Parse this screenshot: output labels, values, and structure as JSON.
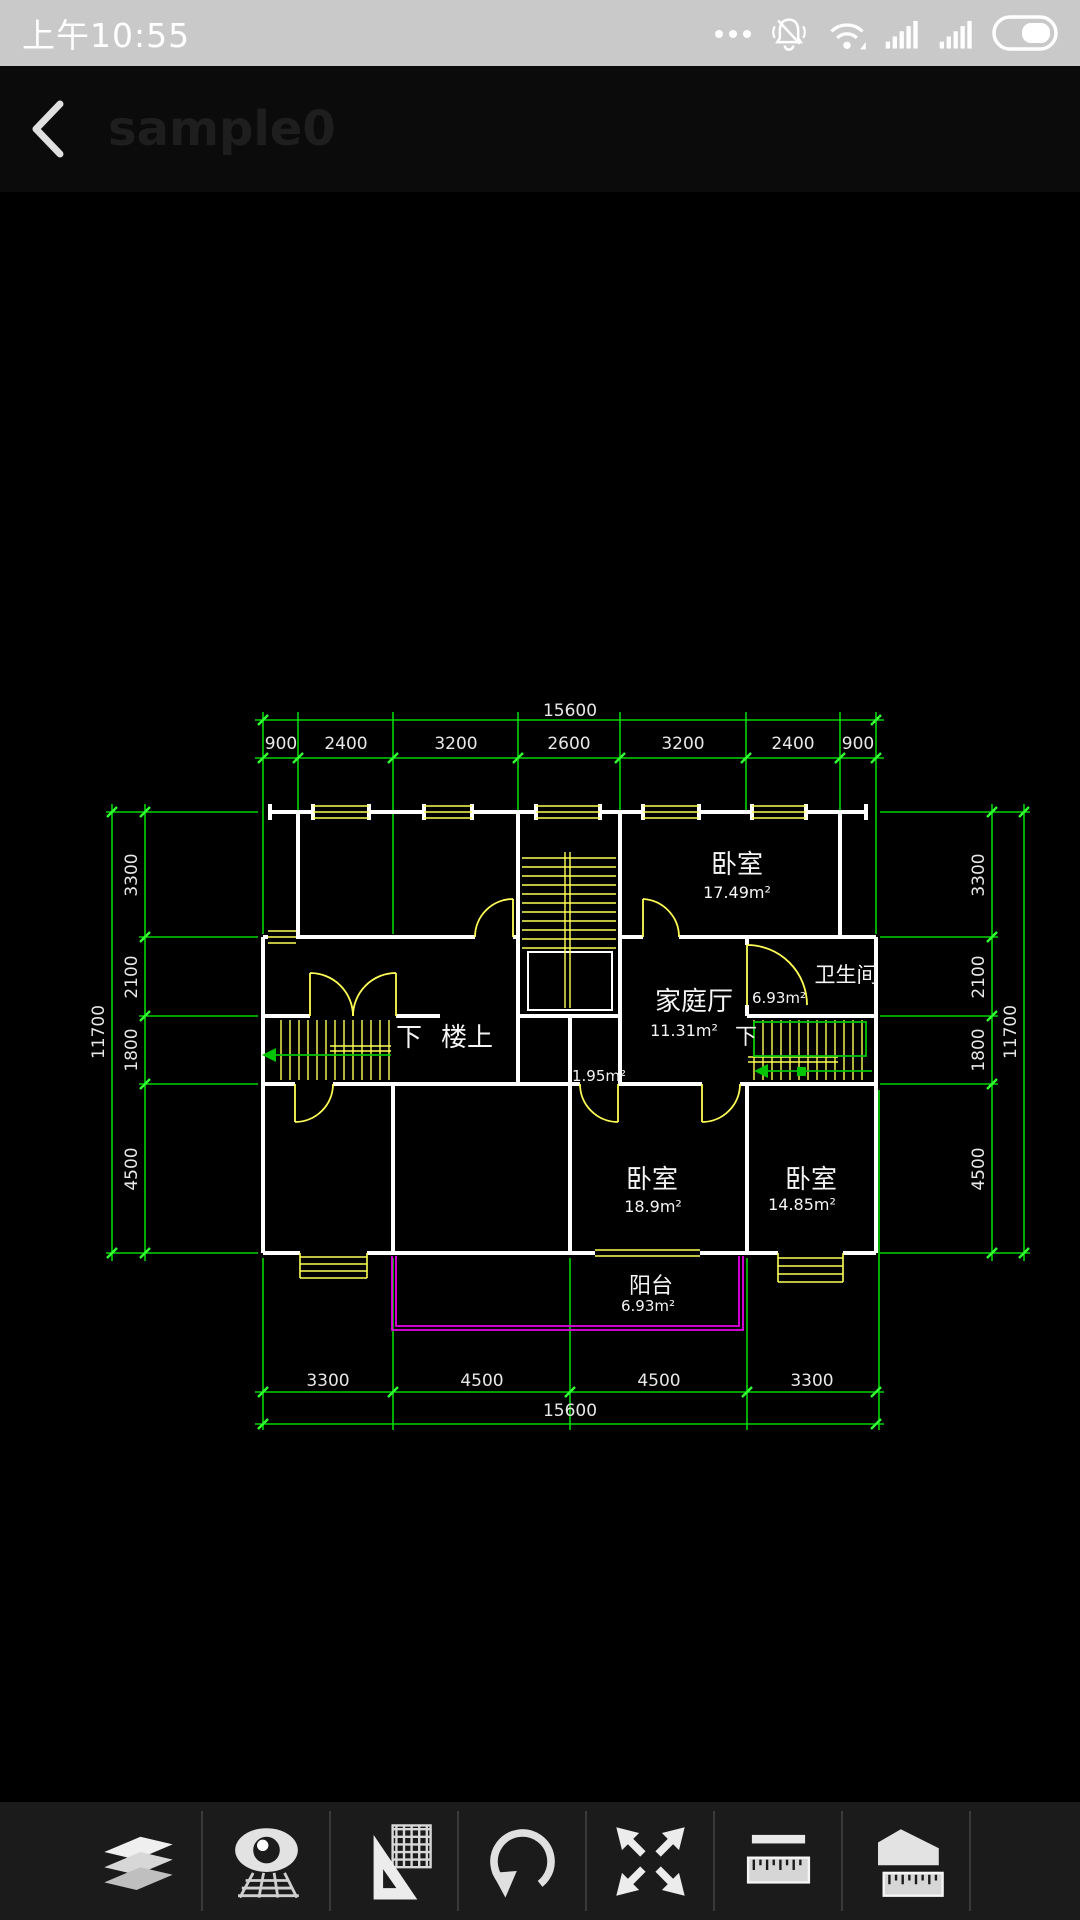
{
  "status_bar": {
    "time": "上午10:55",
    "icons": [
      "more-notifications",
      "mute",
      "wifi",
      "signal-sim1",
      "signal-sim2",
      "battery"
    ]
  },
  "title_bar": {
    "title": "sample0"
  },
  "drawing": {
    "dimensions": {
      "top_total": "15600",
      "top_segments": [
        "900",
        "2400",
        "3200",
        "2600",
        "3200",
        "2400",
        "900"
      ],
      "left_total": "11700",
      "left_segments": [
        "3300",
        "2100",
        "1800",
        "4500"
      ],
      "right_total": "11700",
      "right_segments": [
        "3300",
        "2100",
        "1800",
        "4500"
      ],
      "bottom_segments": [
        "3300",
        "4500",
        "4500",
        "3300"
      ],
      "bottom_total": "15600"
    },
    "rooms": [
      {
        "id": "bedroom-top",
        "name": "卧室",
        "area": "17.49m²"
      },
      {
        "id": "bathroom",
        "name": "卫生间",
        "area": "6.93m²"
      },
      {
        "id": "family-hall",
        "name": "家庭厅",
        "area": "11.31m²"
      },
      {
        "id": "bedroom-left",
        "name": "卧室",
        "area": "18.9m²"
      },
      {
        "id": "bedroom-right",
        "name": "卧室",
        "area": "14.85m²"
      },
      {
        "id": "balcony",
        "name": "阳台",
        "area": "6.93m²"
      }
    ],
    "annotations": {
      "down_left": "下",
      "upstairs": "楼上",
      "down_right": "下",
      "closet_area": "1.95m²"
    },
    "colors": {
      "dimension_line": "#00d400",
      "tick": "#33ff33",
      "wall": "#ffffff",
      "window_door": "#ffff55",
      "balcony_line": "#e800e8",
      "label_text": "#f2f2f2"
    }
  },
  "toolbar": {
    "items": [
      {
        "name": "layers"
      },
      {
        "name": "visual-style"
      },
      {
        "name": "drawing-tools"
      },
      {
        "name": "rotate"
      },
      {
        "name": "fit-screen"
      },
      {
        "name": "measure-length"
      },
      {
        "name": "measure-area"
      }
    ]
  }
}
